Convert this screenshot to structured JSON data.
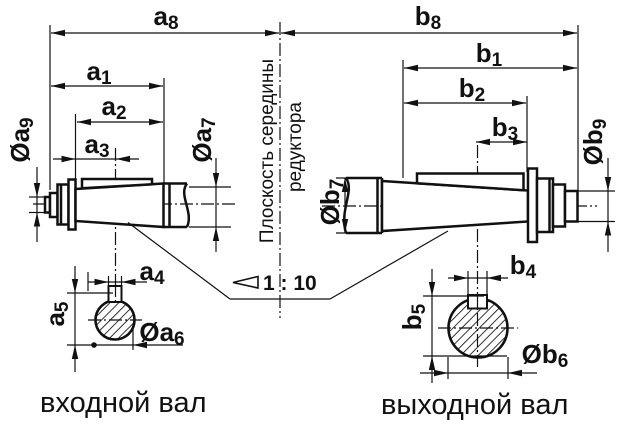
{
  "drawing": {
    "dim_labels": {
      "a1": {
        "base": "a",
        "sub": "1"
      },
      "a2": {
        "base": "a",
        "sub": "2"
      },
      "a3": {
        "base": "a",
        "sub": "3"
      },
      "a4": {
        "base": "a",
        "sub": "4"
      },
      "a5": {
        "base": "a",
        "sub": "5"
      },
      "a6": {
        "base": "Øa",
        "sub": "6"
      },
      "a7": {
        "base": "Øa",
        "sub": "7"
      },
      "a8": {
        "base": "a",
        "sub": "8"
      },
      "a9": {
        "base": "Øa",
        "sub": "9"
      },
      "b1": {
        "base": "b",
        "sub": "1"
      },
      "b2": {
        "base": "b",
        "sub": "2"
      },
      "b3": {
        "base": "b",
        "sub": "3"
      },
      "b4": {
        "base": "b",
        "sub": "4"
      },
      "b5": {
        "base": "b",
        "sub": "5"
      },
      "b6": {
        "base": "Øb",
        "sub": "6"
      },
      "b7": {
        "base": "Øb",
        "sub": "7"
      },
      "b8": {
        "base": "b",
        "sub": "8"
      },
      "b9": {
        "base": "Øb",
        "sub": "9"
      }
    },
    "center_plane_label": {
      "line1": "Плоскость середины",
      "line2": "редуктора"
    },
    "taper_label": "1 : 10",
    "captions": {
      "input_shaft": "входной вал",
      "output_shaft": "выходной вал"
    },
    "colors": {
      "line": "#111111",
      "background": "#ffffff"
    }
  }
}
